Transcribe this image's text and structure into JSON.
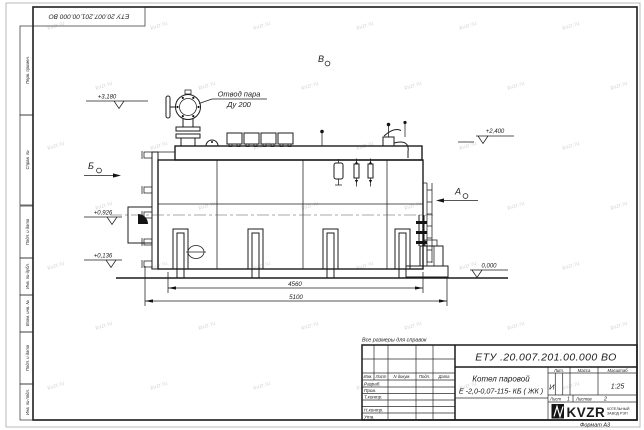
{
  "frame": {
    "corner_stamp": "ЕТУ 20.007.201.00.000  ВО",
    "margin_boxes": [
      "Перв. примен.",
      "Справ. №",
      "Подп. и дата",
      "Инв. № дубл.",
      "Взам. инв. №",
      "Подп. и дата",
      "Инв. № подл."
    ],
    "format_label": "Формат А3"
  },
  "drawing": {
    "note": "Все размеры для справок",
    "steam_outlet_line1": "Отвод пара",
    "steam_outlet_line2": "Ду 200",
    "views": [
      "Б",
      "А",
      "В"
    ],
    "elevations": [
      "+3,180",
      "+2,400",
      "+0,926",
      "+0,136",
      "0,000"
    ],
    "dimensions": [
      "4560",
      "5100"
    ]
  },
  "title_block": {
    "doc_number": "ЕТУ .20.007.201.00.000  ВО",
    "product_name_line1": "Котел паровой",
    "product_name_line2": "Е -2,0-0,07-115- КБ ( ЖК )",
    "columns": {
      "izm": "Изм.",
      "list": "Лист",
      "doc": "N докум.",
      "sign": "Подп.",
      "date": "Дата"
    },
    "rows": [
      "Разраб.",
      "Пров.",
      "Т.контр.",
      "Н.контр.",
      "Утв."
    ],
    "lit_label": "Лит.",
    "lit_value": "И",
    "mass_label": "Масса",
    "scale_label": "Масштаб",
    "scale_value": "1:25",
    "sheet_label": "Лист",
    "sheet_value": "1",
    "sheets_label": "Листов",
    "sheets_value": "2",
    "company_logo": "KVZR",
    "company_line1": "КОТЕЛЬНЫЙ",
    "company_line2": "ЗАВОД РЭП"
  },
  "watermark": "kvzr.ru"
}
